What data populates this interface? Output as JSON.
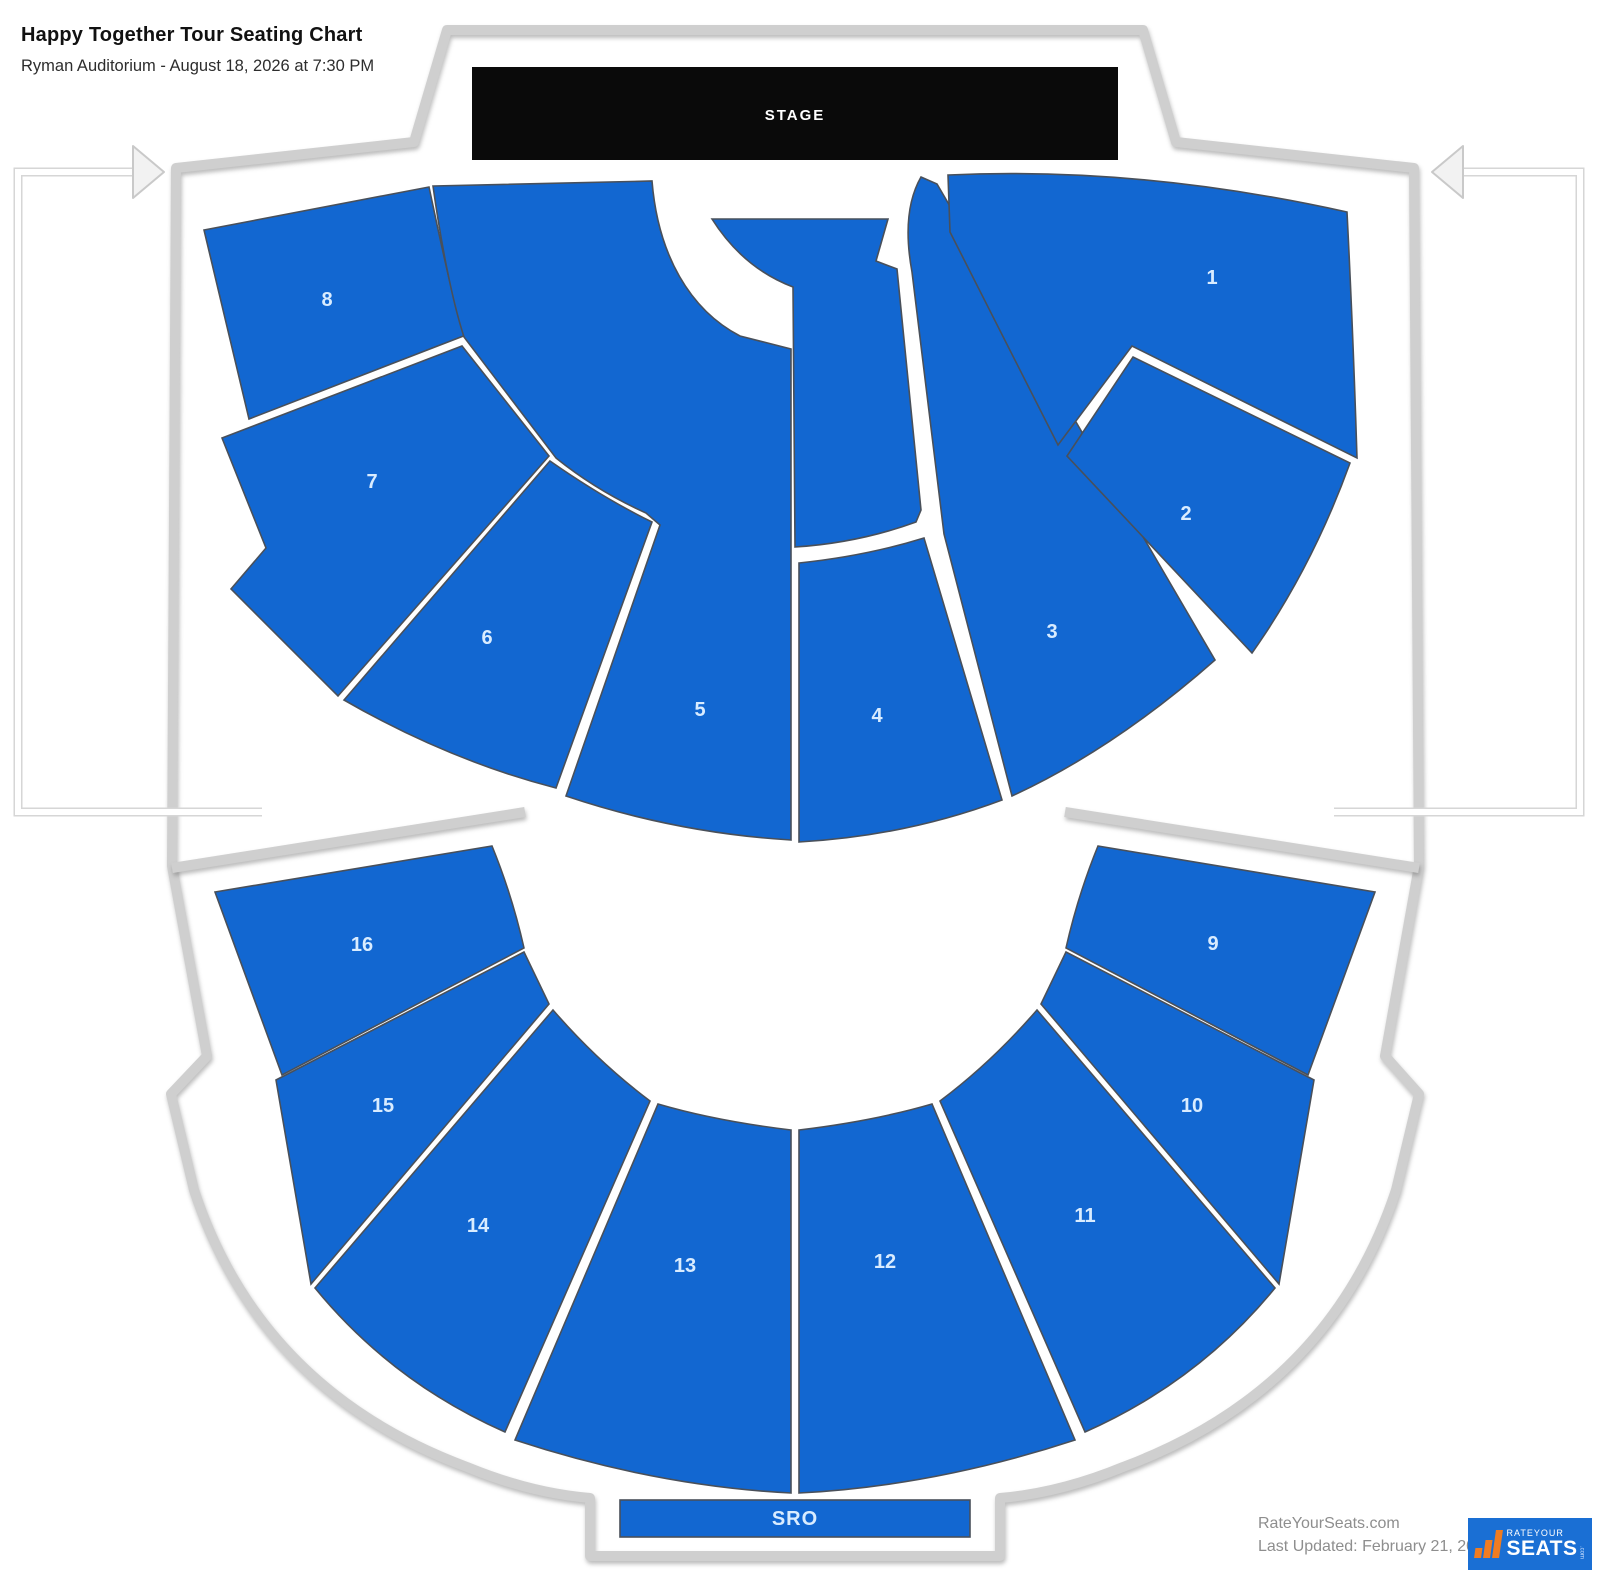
{
  "header": {
    "title": "Happy Together Tour Seating Chart",
    "subtitle": "Ryman Auditorium - August 18, 2026 at 7:30 PM"
  },
  "stage": {
    "label": "STAGE"
  },
  "sro": {
    "label": "SRO"
  },
  "section_labels": [
    "1",
    "2",
    "3",
    "4",
    "5",
    "6",
    "7",
    "8",
    "9",
    "10",
    "11",
    "12",
    "13",
    "14",
    "15",
    "16"
  ],
  "footer": {
    "site": "RateYourSeats.com",
    "updated": "Last Updated: February 21, 2026"
  },
  "logo": {
    "brand_top": "RATEYOUR",
    "brand_bottom": "SEATS",
    "brand_suffix": ".com"
  },
  "colors": {
    "section": "#1267d1",
    "section_border": "#49505a",
    "section_label": "#d9ecff",
    "stage": "#0a0a0a",
    "wall": "#cfcfcf",
    "accent_orange": "#f07c21",
    "logo_bg": "#1a6fd4",
    "footer_text": "#8e8e8e"
  }
}
